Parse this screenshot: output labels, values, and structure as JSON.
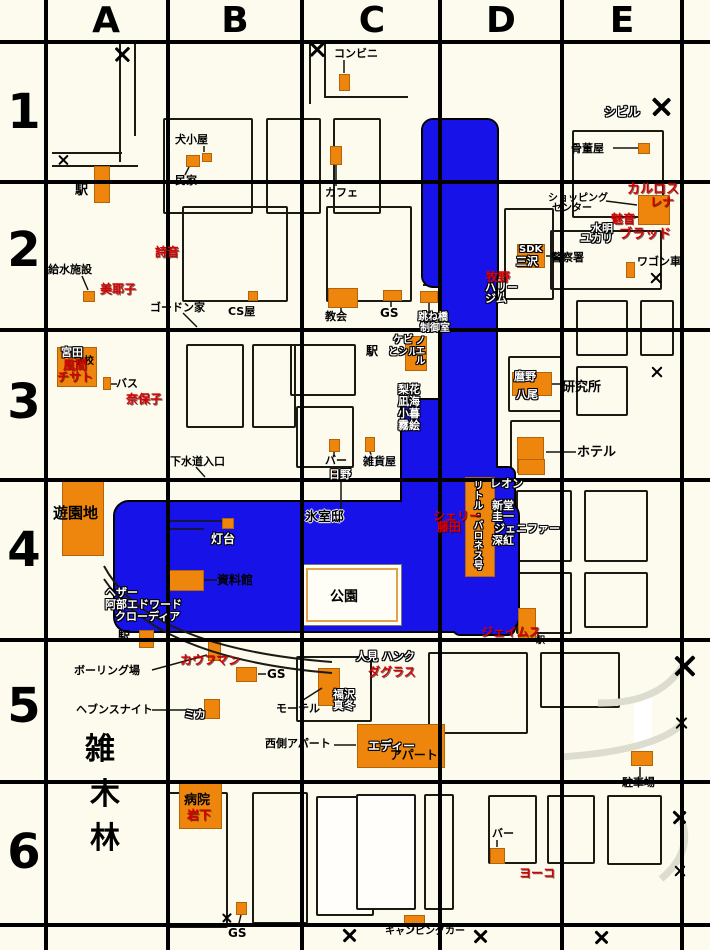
{
  "map": {
    "colors": {
      "background": "#FCFBEE",
      "water": "#1713E8",
      "building": "#EE860D",
      "red_name": "#D80000",
      "park_frame": "#E0A24A"
    },
    "grid": {
      "cols": [
        "A",
        "B",
        "C",
        "D",
        "E"
      ],
      "rows": [
        "1",
        "2",
        "3",
        "4",
        "5",
        "6"
      ],
      "col_lines": [
        46,
        168,
        302,
        440,
        562,
        682
      ],
      "row_lines": [
        42,
        182,
        330,
        480,
        640,
        782,
        925
      ],
      "col_centers": [
        106,
        235,
        372,
        501,
        622
      ],
      "row_centers": [
        110,
        248,
        400,
        548,
        704,
        850
      ]
    },
    "water": [
      [
        421,
        118,
        78,
        170,
        12
      ],
      [
        438,
        275,
        60,
        135,
        4
      ],
      [
        400,
        398,
        98,
        112,
        10
      ],
      [
        113,
        500,
        407,
        133,
        16
      ],
      [
        452,
        466,
        64,
        170,
        8
      ]
    ],
    "park": {
      "x": 302,
      "y": 564,
      "w": 100,
      "h": 62
    },
    "street_blocks": [
      [
        163,
        118,
        90,
        96
      ],
      [
        266,
        118,
        55,
        96
      ],
      [
        333,
        118,
        48,
        96
      ],
      [
        182,
        206,
        106,
        96
      ],
      [
        326,
        206,
        86,
        96
      ],
      [
        504,
        208,
        50,
        92
      ],
      [
        572,
        130,
        92,
        88
      ],
      [
        550,
        230,
        112,
        60
      ],
      [
        186,
        344,
        58,
        84
      ],
      [
        252,
        344,
        44,
        84
      ],
      [
        290,
        344,
        66,
        52
      ],
      [
        296,
        406,
        58,
        62
      ],
      [
        508,
        356,
        54,
        56
      ],
      [
        510,
        420,
        54,
        60
      ],
      [
        576,
        300,
        52,
        56
      ],
      [
        640,
        300,
        34,
        56
      ],
      [
        576,
        366,
        52,
        50
      ],
      [
        516,
        490,
        56,
        72
      ],
      [
        584,
        490,
        64,
        72
      ],
      [
        516,
        572,
        56,
        62
      ],
      [
        584,
        572,
        64,
        56
      ],
      [
        428,
        652,
        100,
        82
      ],
      [
        540,
        652,
        80,
        56
      ],
      [
        296,
        656,
        76,
        66
      ],
      [
        166,
        792,
        62,
        136
      ],
      [
        252,
        792,
        56,
        132
      ],
      [
        316,
        796,
        58,
        120,
        1
      ],
      [
        356,
        794,
        60,
        116,
        1
      ],
      [
        424,
        794,
        30,
        116
      ],
      [
        488,
        795,
        49,
        69
      ],
      [
        547,
        795,
        48,
        69
      ],
      [
        607,
        795,
        55,
        70
      ]
    ],
    "roads": [
      [
        119,
        44,
        2,
        118
      ],
      [
        134,
        44,
        2,
        92
      ],
      [
        52,
        152,
        70,
        2
      ],
      [
        52,
        165,
        86,
        2
      ],
      [
        309,
        44,
        2,
        60
      ],
      [
        324,
        44,
        2,
        52
      ],
      [
        324,
        96,
        84,
        2
      ],
      [
        423,
        284,
        75,
        2
      ],
      [
        423,
        295,
        75,
        2
      ]
    ],
    "buildings": [
      [
        94,
        166,
        16,
        37
      ],
      [
        186,
        155,
        14,
        12
      ],
      [
        202,
        153,
        10,
        9
      ],
      [
        339,
        74,
        11,
        17
      ],
      [
        330,
        146,
        12,
        19
      ],
      [
        638,
        143,
        12,
        11
      ],
      [
        638,
        195,
        32,
        30
      ],
      [
        517,
        244,
        28,
        24
      ],
      [
        626,
        262,
        9,
        16
      ],
      [
        83,
        291,
        12,
        11
      ],
      [
        248,
        291,
        10,
        10
      ],
      [
        328,
        288,
        30,
        20
      ],
      [
        383,
        290,
        19,
        11
      ],
      [
        420,
        291,
        18,
        12
      ],
      [
        405,
        336,
        22,
        35
      ],
      [
        57,
        347,
        40,
        40
      ],
      [
        103,
        377,
        8,
        13
      ],
      [
        512,
        372,
        40,
        24
      ],
      [
        517,
        437,
        27,
        36
      ],
      [
        329,
        439,
        11,
        13
      ],
      [
        365,
        437,
        10,
        15
      ],
      [
        333,
        469,
        13,
        13
      ],
      [
        62,
        478,
        42,
        78
      ],
      [
        222,
        518,
        12,
        11
      ],
      [
        169,
        570,
        35,
        21
      ],
      [
        465,
        477,
        30,
        100
      ],
      [
        518,
        459,
        27,
        16
      ],
      [
        518,
        608,
        18,
        32
      ],
      [
        139,
        630,
        15,
        18
      ],
      [
        208,
        640,
        13,
        21
      ],
      [
        236,
        667,
        21,
        15
      ],
      [
        204,
        699,
        16,
        20
      ],
      [
        318,
        668,
        22,
        38
      ],
      [
        357,
        724,
        88,
        44
      ],
      [
        179,
        783,
        43,
        46
      ],
      [
        631,
        751,
        22,
        15
      ],
      [
        490,
        848,
        15,
        16
      ],
      [
        236,
        902,
        11,
        13
      ],
      [
        404,
        915,
        21,
        11
      ]
    ],
    "lines": [
      [
        344,
        60,
        344,
        73
      ],
      [
        336,
        165,
        336,
        186
      ],
      [
        189,
        167,
        185,
        175
      ],
      [
        204,
        146,
        204,
        152
      ],
      [
        613,
        148,
        638,
        148
      ],
      [
        606,
        201,
        637,
        205
      ],
      [
        82,
        276,
        88,
        290
      ],
      [
        183,
        313,
        197,
        327
      ],
      [
        546,
        256,
        552,
        256
      ],
      [
        341,
        308,
        341,
        312
      ],
      [
        391,
        301,
        391,
        307
      ],
      [
        429,
        303,
        429,
        314
      ],
      [
        111,
        384,
        117,
        384
      ],
      [
        196,
        467,
        205,
        477
      ],
      [
        334,
        452,
        334,
        456
      ],
      [
        370,
        452,
        372,
        457
      ],
      [
        341,
        482,
        341,
        511
      ],
      [
        170,
        521,
        222,
        521
      ],
      [
        170,
        529,
        204,
        529
      ],
      [
        204,
        580,
        217,
        580
      ],
      [
        552,
        384,
        561,
        384
      ],
      [
        546,
        452,
        576,
        452
      ],
      [
        152,
        670,
        207,
        655
      ],
      [
        152,
        710,
        203,
        710
      ],
      [
        258,
        674,
        266,
        674
      ],
      [
        300,
        702,
        322,
        688
      ],
      [
        334,
        745,
        356,
        745
      ],
      [
        640,
        767,
        640,
        777
      ],
      [
        497,
        840,
        497,
        847
      ],
      [
        241,
        915,
        238,
        927
      ],
      [
        414,
        926,
        412,
        931
      ]
    ],
    "decor_paths": [
      {
        "d": "M104,566 Q148,648 332,662",
        "c": "#1b1b14",
        "w": 2
      },
      {
        "d": "M104,579 Q158,659 332,673",
        "c": "#1b1b14",
        "w": 2
      },
      {
        "d": "M643,697 L643,750",
        "c": "#FFFFFF",
        "w": 18
      },
      {
        "d": "M598,703 Q660,704 683,665",
        "c": "#DCDCCF",
        "w": 7
      },
      {
        "d": "M560,757 Q652,751 681,725",
        "c": "#DCDCCF",
        "w": 7
      },
      {
        "d": "M661,879 Q694,851 681,819",
        "c": "#DCDCCF",
        "w": 7
      }
    ],
    "xmarks": [
      [
        122,
        54,
        16
      ],
      [
        63,
        160,
        11
      ],
      [
        317,
        49,
        16
      ],
      [
        662,
        107,
        20
      ],
      [
        656,
        278,
        12
      ],
      [
        657,
        372,
        12
      ],
      [
        685,
        666,
        22
      ],
      [
        682,
        723,
        13
      ],
      [
        680,
        817,
        15
      ],
      [
        680,
        871,
        12
      ],
      [
        227,
        918,
        10
      ],
      [
        350,
        935,
        15
      ],
      [
        481,
        936,
        15
      ],
      [
        602,
        937,
        15
      ]
    ],
    "labels": [
      {
        "t": "コンビニ",
        "x": 334,
        "y": 48,
        "s": "b"
      },
      {
        "t": "犬小屋",
        "x": 175,
        "y": 134,
        "s": "b"
      },
      {
        "t": "民家",
        "x": 175,
        "y": 175,
        "s": "b"
      },
      {
        "t": "駅",
        "x": 75,
        "y": 184,
        "s": "b",
        "f": 13
      },
      {
        "t": "シビル",
        "x": 604,
        "y": 106,
        "s": "w",
        "f": 12
      },
      {
        "t": "骨董屋",
        "x": 571,
        "y": 143,
        "s": "b"
      },
      {
        "t": "カフェ",
        "x": 325,
        "y": 187,
        "s": "b"
      },
      {
        "t": "カルロス",
        "x": 627,
        "y": 183,
        "s": "r",
        "f": 13
      },
      {
        "t": "レナ",
        "x": 650,
        "y": 196,
        "s": "r",
        "f": 12
      },
      {
        "t": "ショッピング",
        "x": 548,
        "y": 194,
        "s": "b",
        "f": 10
      },
      {
        "t": "センター",
        "x": 552,
        "y": 204,
        "s": "b",
        "f": 10
      },
      {
        "t": "魅音",
        "x": 611,
        "y": 213,
        "s": "r",
        "f": 12
      },
      {
        "t": "水明",
        "x": 591,
        "y": 223,
        "s": "w"
      },
      {
        "t": "ユカリ",
        "x": 580,
        "y": 233,
        "s": "w"
      },
      {
        "t": "ブラッド",
        "x": 619,
        "y": 228,
        "s": "r",
        "f": 13
      },
      {
        "t": "SDK",
        "x": 519,
        "y": 245,
        "s": "w",
        "f": 10
      },
      {
        "t": "三沢",
        "x": 516,
        "y": 256,
        "s": "w"
      },
      {
        "t": "警察署",
        "x": 551,
        "y": 252,
        "s": "b"
      },
      {
        "t": "牧野",
        "x": 486,
        "y": 271,
        "s": "r",
        "f": 12
      },
      {
        "t": "ハリー",
        "x": 485,
        "y": 282,
        "s": "w"
      },
      {
        "t": "ジム",
        "x": 485,
        "y": 293,
        "s": "w"
      },
      {
        "t": "ワゴン車",
        "x": 637,
        "y": 256,
        "s": "b"
      },
      {
        "t": "詩音",
        "x": 155,
        "y": 246,
        "s": "r",
        "f": 12
      },
      {
        "t": "給水施設",
        "x": 48,
        "y": 264,
        "s": "b"
      },
      {
        "t": "美耶子",
        "x": 100,
        "y": 283,
        "s": "r",
        "f": 12
      },
      {
        "t": "ゴードン家",
        "x": 150,
        "y": 302,
        "s": "b"
      },
      {
        "t": "CS屋",
        "x": 228,
        "y": 306,
        "s": "b"
      },
      {
        "t": "教会",
        "x": 325,
        "y": 311,
        "s": "b"
      },
      {
        "t": "GS",
        "x": 380,
        "y": 307,
        "s": "b",
        "f": 12
      },
      {
        "t": "跳ね橋",
        "x": 418,
        "y": 313,
        "s": "w",
        "f": 10
      },
      {
        "t": "制御室",
        "x": 420,
        "y": 324,
        "s": "w",
        "f": 10
      },
      {
        "t": "学校",
        "x": 74,
        "y": 357,
        "s": "b",
        "f": 10
      },
      {
        "t": "宮田",
        "x": 61,
        "y": 347,
        "s": "w"
      },
      {
        "t": "風間",
        "x": 63,
        "y": 359,
        "s": "r",
        "f": 12
      },
      {
        "t": "チサト",
        "x": 57,
        "y": 371,
        "s": "r",
        "f": 12
      },
      {
        "t": "バス",
        "x": 116,
        "y": 378,
        "s": "b"
      },
      {
        "t": "奈保子",
        "x": 126,
        "y": 393,
        "s": "r",
        "f": 12
      },
      {
        "t": "駅",
        "x": 366,
        "y": 345,
        "s": "b",
        "f": 12
      },
      {
        "t": "ケビ",
        "x": 393,
        "y": 336,
        "s": "w",
        "f": 10
      },
      {
        "t": "とシル",
        "x": 388,
        "y": 348,
        "s": "w",
        "f": 10
      },
      {
        "t": "ノエル",
        "x": 413,
        "y": 335,
        "s": "w",
        "f": 10,
        "v": true
      },
      {
        "t": "梨花",
        "x": 398,
        "y": 384,
        "s": "w"
      },
      {
        "t": "凪海",
        "x": 398,
        "y": 396,
        "s": "w"
      },
      {
        "t": "小暮",
        "x": 398,
        "y": 408,
        "s": "w"
      },
      {
        "t": "霧絵",
        "x": 398,
        "y": 420,
        "s": "w"
      },
      {
        "t": "麿野",
        "x": 514,
        "y": 371,
        "s": "w"
      },
      {
        "t": "八尾",
        "x": 516,
        "y": 389,
        "s": "w"
      },
      {
        "t": "研究所",
        "x": 562,
        "y": 381,
        "s": "b",
        "f": 13
      },
      {
        "t": "ホテル",
        "x": 577,
        "y": 446,
        "s": "b",
        "f": 13
      },
      {
        "t": "下水道入口",
        "x": 170,
        "y": 456,
        "s": "b"
      },
      {
        "t": "バー",
        "x": 325,
        "y": 455,
        "s": "b"
      },
      {
        "t": "雑貨屋",
        "x": 363,
        "y": 456,
        "s": "halo"
      },
      {
        "t": "日野",
        "x": 329,
        "y": 469,
        "s": "w"
      },
      {
        "t": "遊園地",
        "x": 53,
        "y": 506,
        "s": "b",
        "f": 15
      },
      {
        "t": "灯台",
        "x": 211,
        "y": 533,
        "s": "w",
        "f": 12
      },
      {
        "t": "氷室邸",
        "x": 305,
        "y": 511,
        "s": "halo",
        "f": 13
      },
      {
        "t": "資料館",
        "x": 217,
        "y": 574,
        "s": "b",
        "f": 12
      },
      {
        "t": "ヘザー",
        "x": 105,
        "y": 587,
        "s": "w"
      },
      {
        "t": "阿部エドワード",
        "x": 105,
        "y": 599,
        "s": "w"
      },
      {
        "t": "クローディア",
        "x": 115,
        "y": 611,
        "s": "w"
      },
      {
        "t": "レオン",
        "x": 490,
        "y": 478,
        "s": "w"
      },
      {
        "t": "新堂",
        "x": 492,
        "y": 500,
        "s": "w"
      },
      {
        "t": "圭一",
        "x": 492,
        "y": 511,
        "s": "w"
      },
      {
        "t": "ジェニファー",
        "x": 494,
        "y": 523,
        "s": "w"
      },
      {
        "t": "深紅",
        "x": 492,
        "y": 535,
        "s": "w"
      },
      {
        "t": "リトル・バロネス号",
        "x": 471,
        "y": 480,
        "s": "w",
        "f": 10,
        "v": true
      },
      {
        "t": "シェリー",
        "x": 433,
        "y": 510,
        "s": "r",
        "f": 12
      },
      {
        "t": "藤田",
        "x": 437,
        "y": 521,
        "s": "r",
        "f": 12
      },
      {
        "t": "公園",
        "x": 330,
        "y": 590,
        "s": "b",
        "f": 14
      },
      {
        "t": "駅",
        "x": 118,
        "y": 630,
        "s": "b",
        "f": 12
      },
      {
        "t": "ジェイムス",
        "x": 481,
        "y": 626,
        "s": "r",
        "f": 12
      },
      {
        "t": "駅",
        "x": 536,
        "y": 637,
        "s": "b",
        "f": 9
      },
      {
        "t": "カウフマン",
        "x": 180,
        "y": 654,
        "s": "r",
        "f": 12
      },
      {
        "t": "ボーリング場",
        "x": 74,
        "y": 665,
        "s": "b"
      },
      {
        "t": "GS",
        "x": 267,
        "y": 668,
        "s": "b",
        "f": 12
      },
      {
        "t": "ヘブンスナイト",
        "x": 76,
        "y": 704,
        "s": "b"
      },
      {
        "t": "ミカ",
        "x": 184,
        "y": 709,
        "s": "w"
      },
      {
        "t": "モーテル",
        "x": 276,
        "y": 703,
        "s": "b"
      },
      {
        "t": "福沢",
        "x": 333,
        "y": 689,
        "s": "w"
      },
      {
        "t": "真冬",
        "x": 333,
        "y": 700,
        "s": "w"
      },
      {
        "t": "人見 ハンク",
        "x": 356,
        "y": 651,
        "s": "w"
      },
      {
        "t": "ダグラス",
        "x": 368,
        "y": 666,
        "s": "r",
        "f": 12
      },
      {
        "t": "西側アパート",
        "x": 265,
        "y": 738,
        "s": "b"
      },
      {
        "t": "エディー",
        "x": 368,
        "y": 740,
        "s": "w",
        "f": 12
      },
      {
        "t": "アパート",
        "x": 390,
        "y": 749,
        "s": "b",
        "f": 12
      },
      {
        "t": "雑",
        "x": 85,
        "y": 735,
        "s": "b",
        "f": 30
      },
      {
        "t": "木",
        "x": 90,
        "y": 780,
        "s": "b",
        "f": 30
      },
      {
        "t": "林",
        "x": 90,
        "y": 824,
        "s": "b",
        "f": 30
      },
      {
        "t": "駐車場",
        "x": 622,
        "y": 777,
        "s": "b"
      },
      {
        "t": "病院",
        "x": 184,
        "y": 794,
        "s": "b",
        "f": 13
      },
      {
        "t": "岩下",
        "x": 187,
        "y": 809,
        "s": "r",
        "f": 12
      },
      {
        "t": "バー",
        "x": 492,
        "y": 828,
        "s": "b"
      },
      {
        "t": "ヨーコ",
        "x": 519,
        "y": 867,
        "s": "r",
        "f": 12
      },
      {
        "t": "GS",
        "x": 228,
        "y": 927,
        "s": "b",
        "f": 12
      },
      {
        "t": "キャンピングカー",
        "x": 385,
        "y": 927,
        "s": "b",
        "f": 10
      }
    ]
  }
}
